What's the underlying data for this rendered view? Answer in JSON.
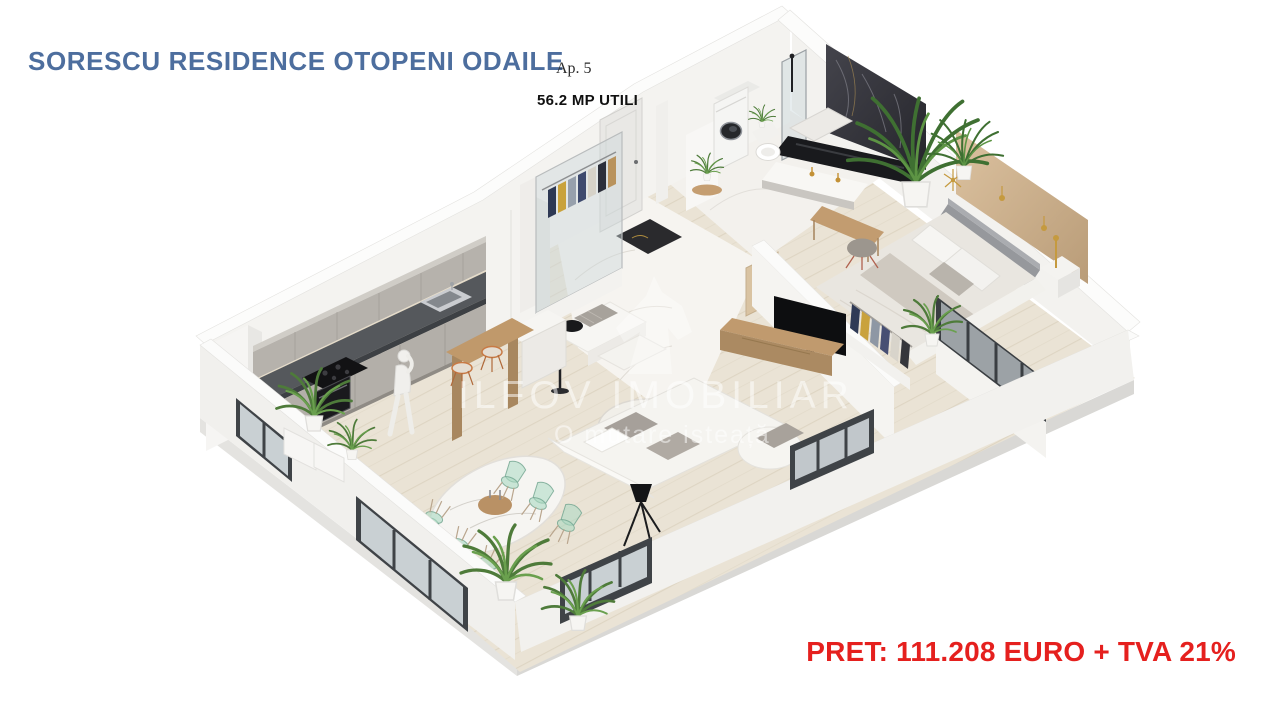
{
  "page": {
    "background_color": "#ffffff"
  },
  "header": {
    "title": "SORESCU RESIDENCE OTOPENI ODAILE",
    "apartment_label": "Ap. 5",
    "area_label": "56.2 MP UTILI"
  },
  "watermark": {
    "brand": "ILFOV IMOBILIAR",
    "slogan": "O mutare isteață",
    "logo_icon": "chess-knight-icon"
  },
  "price": {
    "label": "PRET: 111.208 EURO + TVA 21%"
  },
  "colors": {
    "title_blue": "#4d6e9e",
    "price_red": "#e5201e",
    "floor_wood": "#eae3d5",
    "cabinet_grey": "#b6b2ac",
    "counter_dark": "#55585c",
    "accent_tan": "#cfb28c",
    "dark_marble": "#36363c",
    "plant_green": "#4e7b3a",
    "glass_chair_green": "#a8d3bd"
  },
  "floor_plan": {
    "type": "isometric-3d-apartment-render",
    "rooms": [
      "kitchen",
      "dining-area",
      "living-room",
      "hallway-entry",
      "laundry-nook",
      "bathroom",
      "bedroom"
    ]
  }
}
